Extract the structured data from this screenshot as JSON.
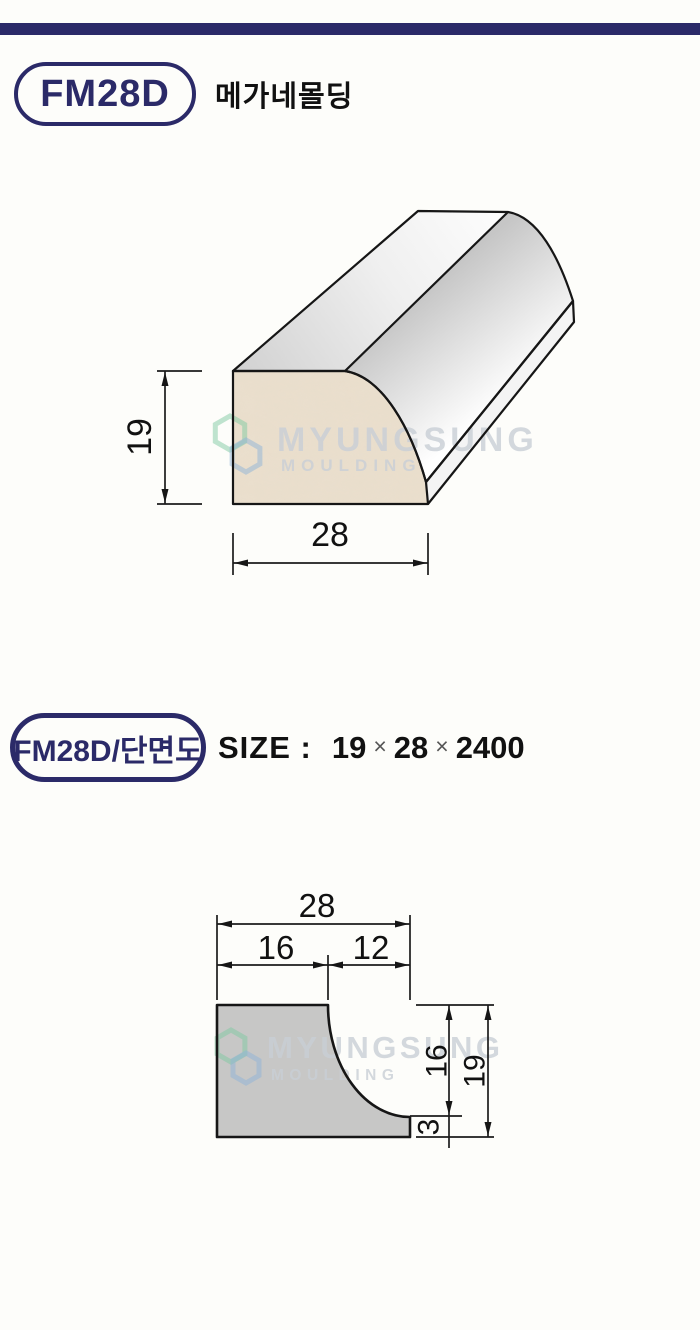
{
  "header": {
    "code": "FM28D",
    "name": "메가네몰딩"
  },
  "section_header": {
    "badge": "FM28D/단면도",
    "size_label": "SIZE :",
    "size_value": {
      "height": "19",
      "width": "28",
      "length": "2400",
      "multiply": "×"
    }
  },
  "watermark": {
    "brand": "MYUNGSUNG",
    "sub": "MOULDING"
  },
  "drawing_3d": {
    "dim_height": "19",
    "dim_width": "28"
  },
  "drawing_section": {
    "dim_total_width": "28",
    "dim_left": "16",
    "dim_right": "12",
    "dim_side_upper": "16",
    "dim_side_lip": "3",
    "dim_side_total": "19"
  },
  "colors": {
    "navy": "#2b2a68",
    "line": "#161616",
    "wood_face": "#eadfce",
    "section_gray": "#c7c7c6",
    "watermark_gray": "#c9cfd6",
    "logo_green": "#7fc9a1",
    "logo_blue": "#8fb4d8"
  }
}
